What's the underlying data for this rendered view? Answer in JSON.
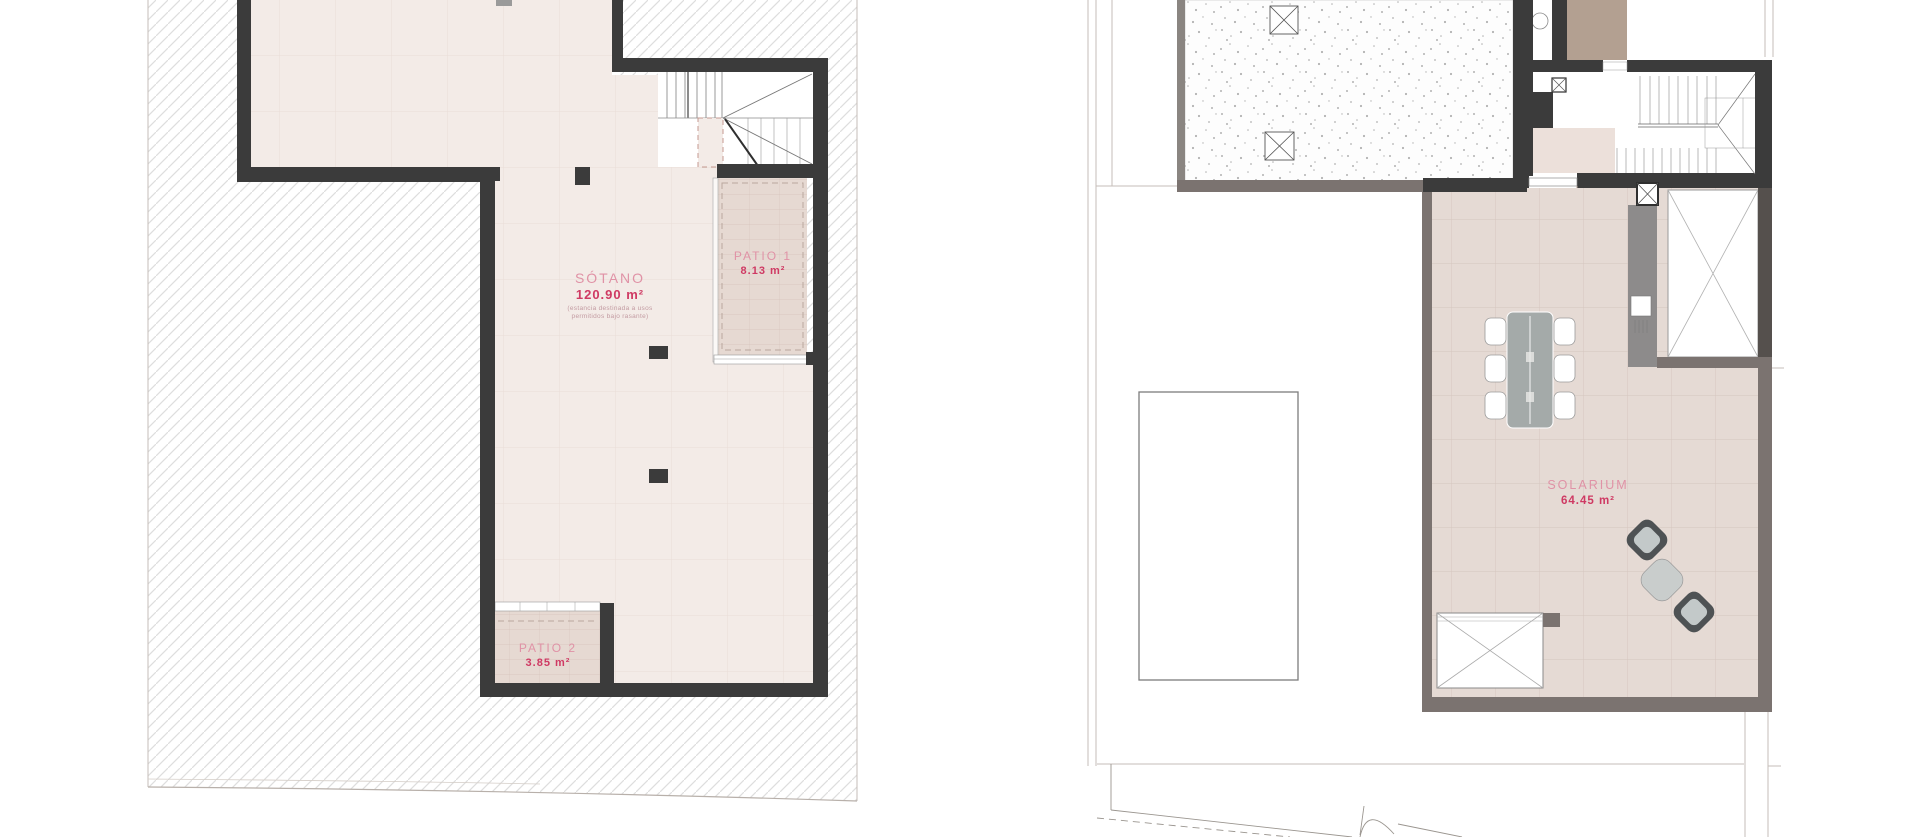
{
  "left_plan": {
    "sotano": {
      "name": "SÓTANO",
      "area": "120.90 m²",
      "note1": "(estancia destinada a usos",
      "note2": "permitidos bajo rasante)"
    },
    "patio1": {
      "name": "PATIO 1",
      "area": "8.13 m²"
    },
    "patio2": {
      "name": "PATIO 2",
      "area": "3.85 m²"
    }
  },
  "right_plan": {
    "solarium": {
      "name": "SOLARIUM",
      "area": "64.45 m²"
    }
  },
  "colors": {
    "area_accent": "#cf3963",
    "room_name_pink": "#e092a6",
    "wall_dark": "#3b3b3b",
    "wall_warm_gray": "#7b7370",
    "basement_floor": "#f3ebe7",
    "terrace_tile": "#e5dad4",
    "patio_fill": "#e6d9d2",
    "brown_block": "#b3a091",
    "gray_band": "#8d8b8b"
  }
}
